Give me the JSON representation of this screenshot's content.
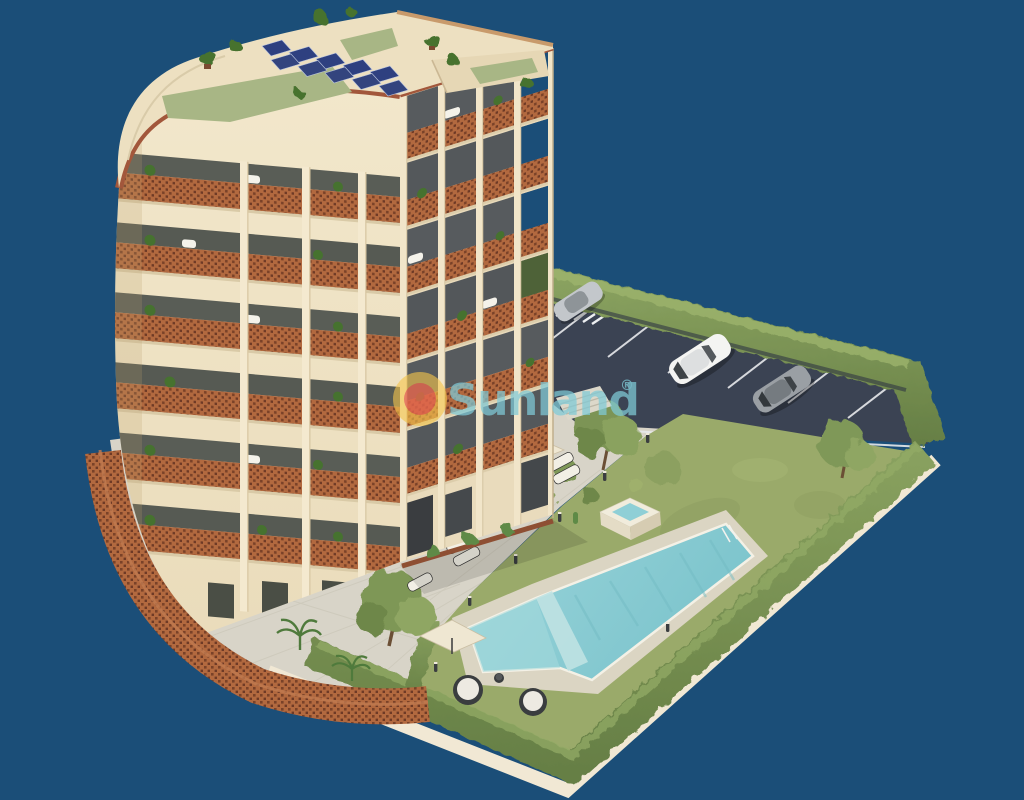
{
  "scene": {
    "title": "3D aerial architectural render of a curved apartment tower with rooftop solar panels, communal pool, garden, hedge fence and parking lot on a dark blue background",
    "background_color": "#1B4E78",
    "features": [
      "curved apartment tower with terracotta brick-lattice balconies",
      "rooftop garden with solar panels and potted plants",
      "L-shaped swimming pool with raised jacuzzi and ladder",
      "sun loungers with cream parasols on paved terrace",
      "two round daybeds with parasol on lawn",
      "lawn garden with olive trees and shrubs",
      "tall perimeter hedge fence",
      "asphalt parking lot with white marked spaces and crosswalk",
      "white car, grey car and silver car parked",
      "curved brick lattice perimeter wall with palm trees"
    ]
  },
  "watermark": {
    "icon": "sun-icon",
    "text": "Sunland",
    "registered_mark": "®",
    "text_color": "#7FCBD8",
    "sun_outer_color": "#F5C54B",
    "sun_inner_color": "#E2574E"
  },
  "palette": {
    "background": "#1B4E78",
    "building_cream": "#F0E4C7",
    "building_shadow_face": "#E8DABB",
    "brick_lattice": "#B2693F",
    "brick_dark": "#7A4228",
    "roof_green": "#A8B685",
    "solar_panel_blue": "#2E4080",
    "lawn_green": "#9AAA6A",
    "hedge_green": "#7E9757",
    "pool_water": "#8FCFD6",
    "paving": "#D8D4C8",
    "asphalt": "#3B4353"
  }
}
